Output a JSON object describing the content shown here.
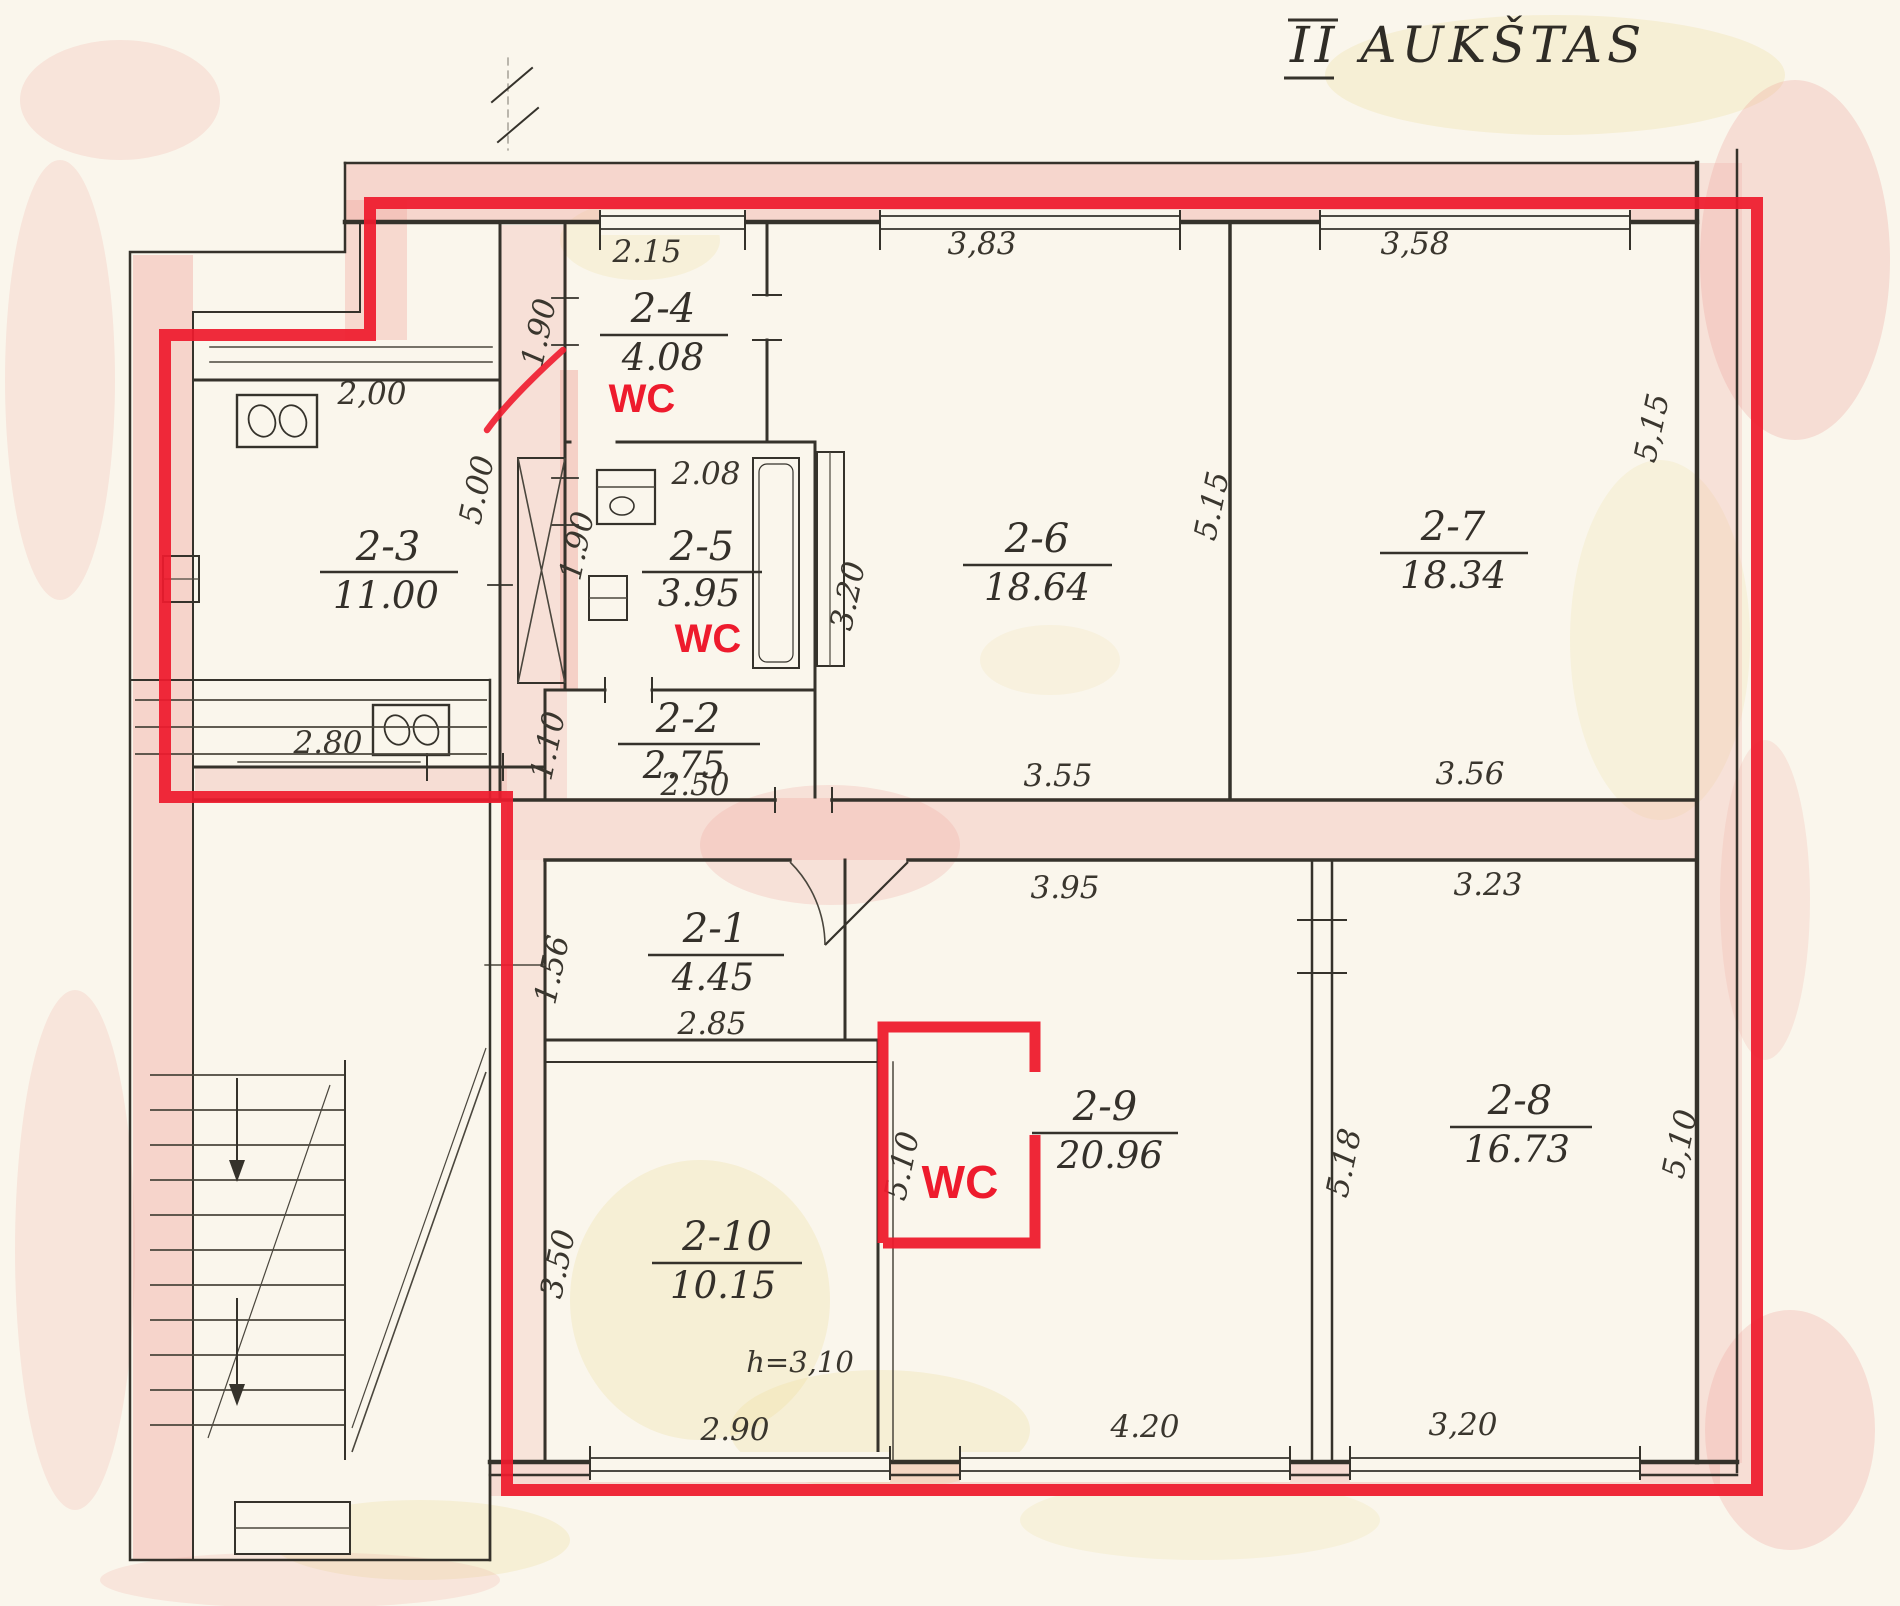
{
  "title": {
    "text": "II AUKŠTAS"
  },
  "colors": {
    "outline_red": "#ee1b2d",
    "ink": "#35322b",
    "pink_wash": "#f0a39c",
    "paper": "#faf6ec"
  },
  "rooms": [
    {
      "id": "2-1",
      "area": "4.45"
    },
    {
      "id": "2-2",
      "area": "2.75"
    },
    {
      "id": "2-3",
      "area": "11.00"
    },
    {
      "id": "2-4",
      "area": "4.08"
    },
    {
      "id": "2-5",
      "area": "3.95"
    },
    {
      "id": "2-6",
      "area": "18.64"
    },
    {
      "id": "2-7",
      "area": "18.34"
    },
    {
      "id": "2-8",
      "area": "16.73"
    },
    {
      "id": "2-9",
      "area": "20.96"
    },
    {
      "id": "2-10",
      "area": "10.15"
    }
  ],
  "wc_labels": {
    "wc_2_4": "WC",
    "wc_2_5": "WC",
    "wc_2_9": "WC"
  },
  "dimensions": {
    "win_2_4": "2.15",
    "left_2_4": "1.90",
    "kitchen_width": "2,00",
    "left_2_3": "5.00",
    "top_2_5": "2.08",
    "left_2_5": "1.90",
    "win_2_6": "3,83",
    "left_2_6": "3.20",
    "win_2_7": "3,58",
    "mid_2_6_2_7": "5.15",
    "right_2_7": "5,15",
    "below_2_3": "2.80",
    "left_2_2": "1.10",
    "below_2_2": "2.50",
    "below_2_6": "3.55",
    "below_2_7": "3.56",
    "left_2_1": "1.56",
    "below_2_1": "2.85",
    "top_2_9": "3.95",
    "top_2_8": "3.23",
    "left_2_9": "5.10",
    "mid_2_9_2_8": "5.18",
    "right_2_8": "5,10",
    "left_2_10": "3.50",
    "height_note": "h=3,10",
    "below_2_10": "2.90",
    "below_2_9": "4.20",
    "below_2_8": "3,20"
  }
}
